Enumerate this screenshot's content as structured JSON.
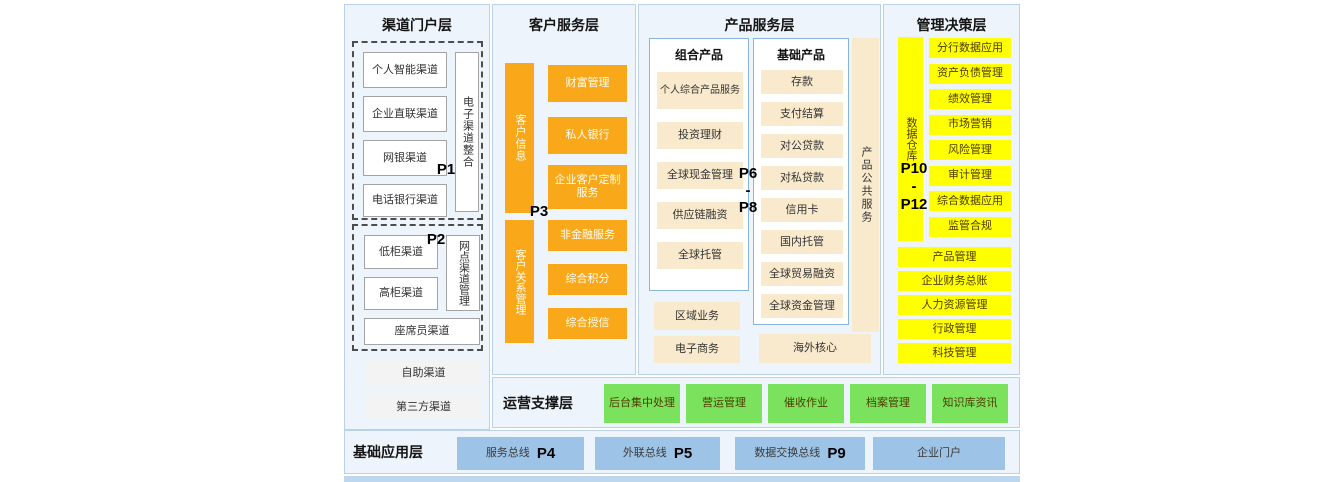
{
  "colors": {
    "column_bg": "#eef4fb",
    "column_border": "#b9d2ea",
    "orange": "#f8a818",
    "cream": "#faeacd",
    "yellow": "#ffff00",
    "green": "#7ae25c",
    "blue": "#9dc3e6",
    "footer_strip": "#bdd7ee"
  },
  "layers": {
    "channel": {
      "title": "渠道门户层",
      "p1": "P1",
      "p2": "P2",
      "group1": {
        "items": [
          "个人智能渠道",
          "企业直联渠道",
          "网银渠道",
          "电话银行渠道"
        ],
        "vertical": "电子渠道整合"
      },
      "group2": {
        "items": [
          "低柜渠道",
          "高柜渠道"
        ],
        "vertical": "网点渠道管理",
        "wide": "座席员渠道"
      },
      "extra": [
        "自助渠道",
        "第三方渠道"
      ]
    },
    "customer": {
      "title": "客户服务层",
      "p3": "P3",
      "top": {
        "vertical": "客户信息",
        "items": [
          "财富管理",
          "私人银行",
          "企业客户定制服务"
        ]
      },
      "bottom": {
        "vertical": "客户关系管理",
        "items": [
          "非金融服务",
          "综合积分",
          "综合授信"
        ]
      }
    },
    "product": {
      "title": "产品服务层",
      "plabel": [
        "P6",
        "-",
        "P8"
      ],
      "combo": {
        "title": "组合产品",
        "items": [
          "个人综合产品服务",
          "投资理财",
          "全球现金管理",
          "供应链融资",
          "全球托管"
        ]
      },
      "basic": {
        "title": "基础产品",
        "items": [
          "存款",
          "支付结算",
          "对公贷款",
          "对私贷款",
          "信用卡",
          "国内托管",
          "全球贸易融资",
          "全球资金管理"
        ]
      },
      "vertical": "产品公共服务",
      "extras": [
        "区域业务",
        "电子商务"
      ],
      "overseas": "海外核心"
    },
    "management": {
      "title": "管理决策层",
      "plabel": [
        "P10",
        "-",
        "P12"
      ],
      "vertical": "数据仓库",
      "items": [
        "分行数据应用",
        "资产负债管理",
        "绩效管理",
        "市场营销",
        "风险管理",
        "审计管理",
        "综合数据应用",
        "监管合规"
      ],
      "wide": [
        "产品管理",
        "企业财务总账",
        "人力资源管理",
        "行政管理",
        "科技管理"
      ]
    },
    "operations": {
      "title": "运营支撑层",
      "items": [
        "后台集中处理",
        "营运管理",
        "催收作业",
        "档案管理",
        "知识库资讯"
      ]
    },
    "foundation": {
      "title": "基础应用层",
      "items": [
        {
          "label": "服务总线",
          "p": "P4"
        },
        {
          "label": "外联总线",
          "p": "P5"
        },
        {
          "label": "数据交换总线",
          "p": "P9"
        },
        {
          "label": "企业门户",
          "p": ""
        }
      ]
    }
  }
}
